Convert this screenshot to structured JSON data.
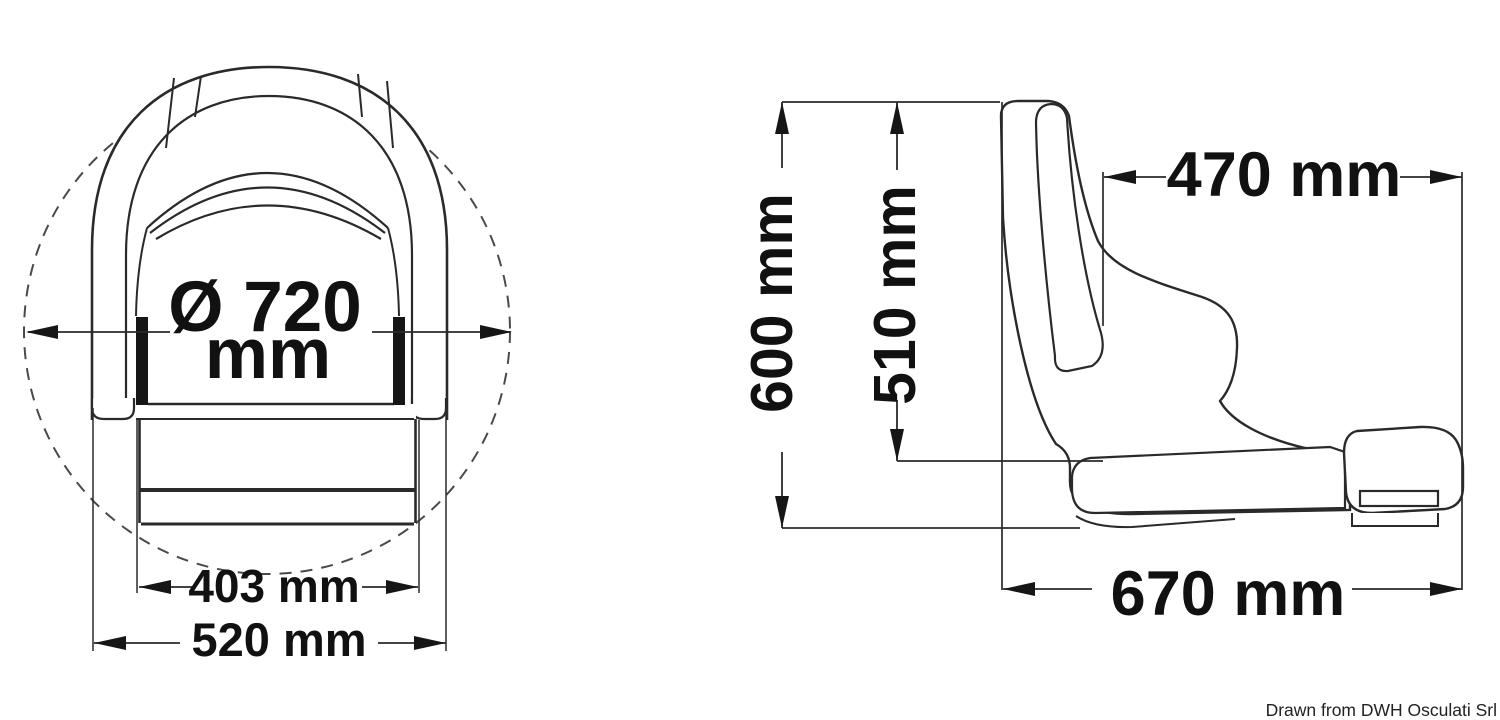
{
  "drawing": {
    "type": "technical-drawing",
    "subject": "helm seat with flip-up bolster, front and side orthographic views",
    "line_color": "#2a2a2a",
    "text_color": "#111111",
    "background": "#ffffff"
  },
  "front_view": {
    "name": "front view",
    "dimensions": {
      "diameter_line1": "Ø 720",
      "diameter_line2": "mm",
      "inner_width": "403 mm",
      "outer_width": "520 mm"
    }
  },
  "side_view": {
    "name": "side view",
    "dimensions": {
      "overall_height": "600 mm",
      "backrest_height": "510 mm",
      "backrest_to_front": "470 mm",
      "overall_depth": "670 mm"
    }
  },
  "footer": {
    "attribution": "Drawn from DWH Osculati Srl"
  }
}
